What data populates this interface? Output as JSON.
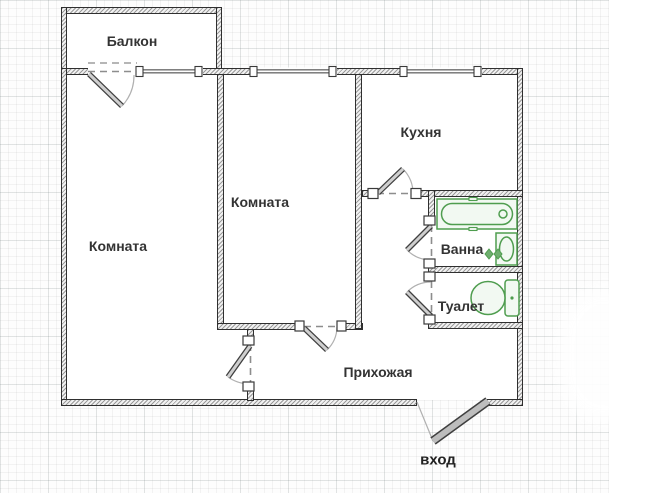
{
  "plan": {
    "type": "apartment-floor-plan",
    "language": "ru",
    "counts": {
      "windows": 3,
      "interior_doors": 6,
      "entrance_doors": 1
    }
  },
  "rooms": [
    {
      "id": "balcony",
      "label": "Балкон"
    },
    {
      "id": "room-left",
      "label": "Комната"
    },
    {
      "id": "room-middle",
      "label": "Комната"
    },
    {
      "id": "kitchen",
      "label": "Кухня"
    },
    {
      "id": "bath",
      "label": "Ванна"
    },
    {
      "id": "toilet",
      "label": "Туалет"
    },
    {
      "id": "hallway",
      "label": "Прихожая"
    },
    {
      "id": "entrance",
      "label": "вход"
    }
  ],
  "fixtures": [
    {
      "name": "bathtub-icon",
      "room": "bath"
    },
    {
      "name": "washbasin-icon",
      "room": "bath"
    },
    {
      "name": "toilet-icon",
      "room": "toilet"
    },
    {
      "name": "entrance-door-icon",
      "room": "entrance"
    }
  ],
  "colors": {
    "wall_outline": "#2f2f2f",
    "wall_hatch": "#9a9a9a",
    "fixture_green": "#4f9d4f",
    "fixture_fill": "#f2f9f2",
    "door_leaf_gray": "#cfcfcf",
    "entrance_leaf_gray": "#bdbdbd",
    "label_text": "#333333",
    "grid_minor": "#f0f0f0",
    "grid_major": "#dfe5e5",
    "background": "#ffffff"
  }
}
